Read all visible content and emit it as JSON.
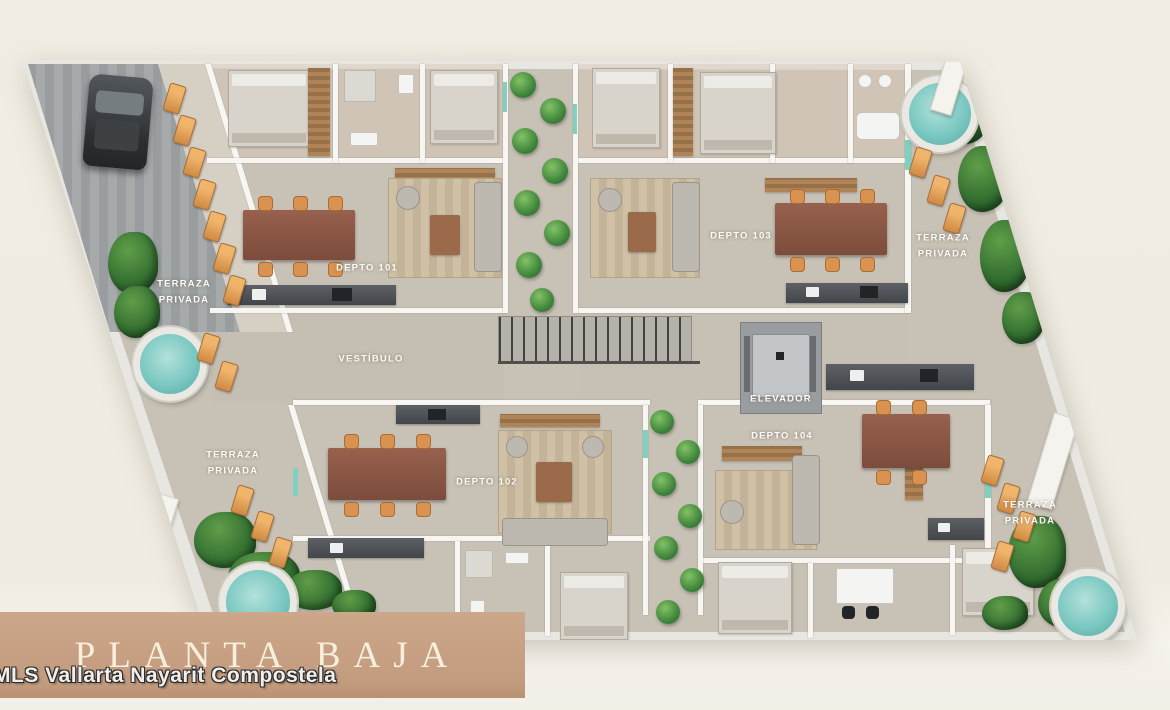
{
  "banner": {
    "title": "PLANTA BAJA"
  },
  "watermark": "MLS Vallarta Nayarit Compostela",
  "plan": {
    "units": [
      {
        "id": "depto-101",
        "label": "DEPTO 101"
      },
      {
        "id": "depto-102",
        "label": "DEPTO 102"
      },
      {
        "id": "depto-103",
        "label": "DEPTO 103"
      },
      {
        "id": "depto-104",
        "label": "DEPTO 104"
      }
    ],
    "rooms": {
      "vestibule": "VESTÍBULO",
      "elevator": "ELEVADOR"
    },
    "terraces": [
      {
        "position": "upper-left",
        "label": "TERRAZA PRIVADA"
      },
      {
        "position": "upper-right",
        "label": "TERRAZA PRIVADA"
      },
      {
        "position": "lower-left",
        "label": "TERRAZA PRIVADA"
      },
      {
        "position": "lower-right",
        "label": "TERRAZA PRIVADA"
      }
    ]
  },
  "colors": {
    "background": "#f1ede3",
    "banner": "#c7a083",
    "floor": "#c8c1b5",
    "pool_water": "#7cc8c2",
    "greenery": "#2f6a2e",
    "wood_furniture": "#8a5746"
  }
}
